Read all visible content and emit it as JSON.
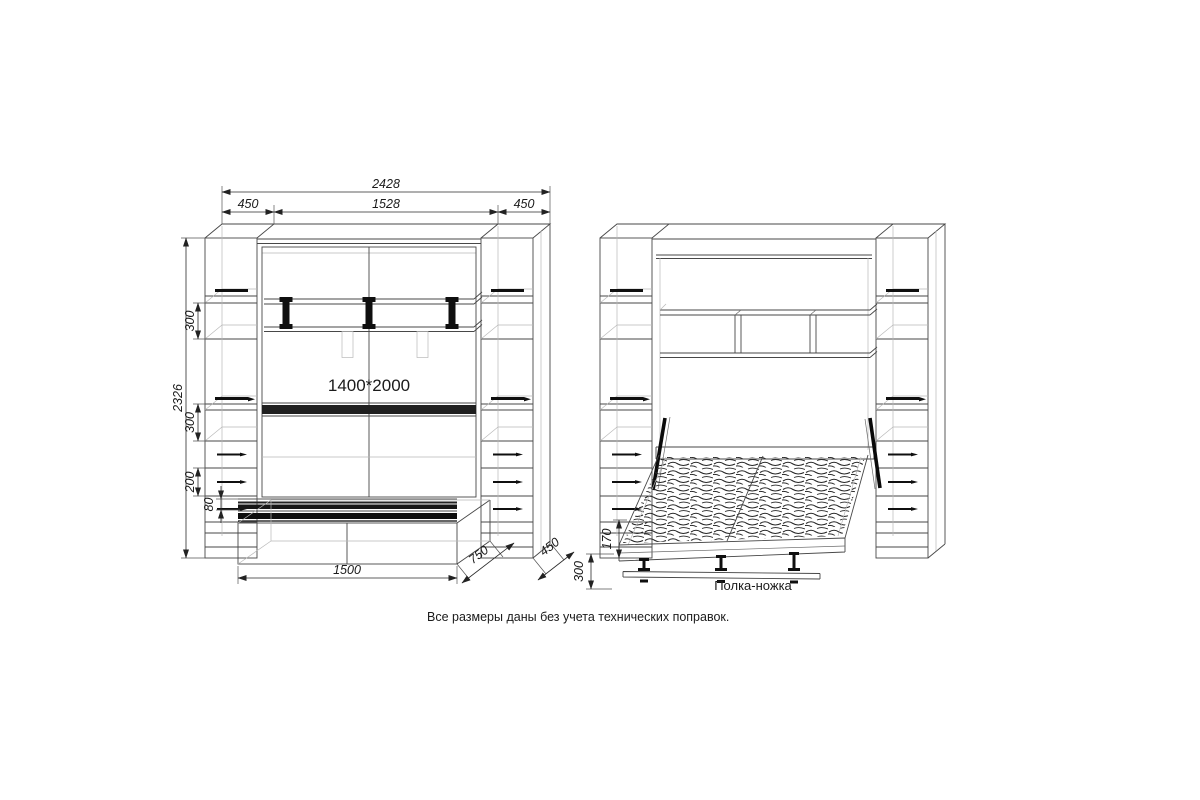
{
  "note": "Все размеры даны без учета технических поправок.",
  "closed_view": {
    "bed_size": "1400*2000",
    "dims": {
      "total_width": "2428",
      "left_width": "450",
      "center_width": "1528",
      "right_width": "450",
      "total_height": "2326",
      "upper_shelf_gap": "300",
      "lower_shelf_gap": "300",
      "drawer_zone": "200",
      "plinth": "80",
      "bench_width": "1500",
      "bench_depth": "750",
      "cabinet_depth": "450"
    }
  },
  "open_view": {
    "shelf_leg_label": "Полка-ножка",
    "dims": {
      "frame_height": "170",
      "shelf_leg_height": "300"
    }
  }
}
